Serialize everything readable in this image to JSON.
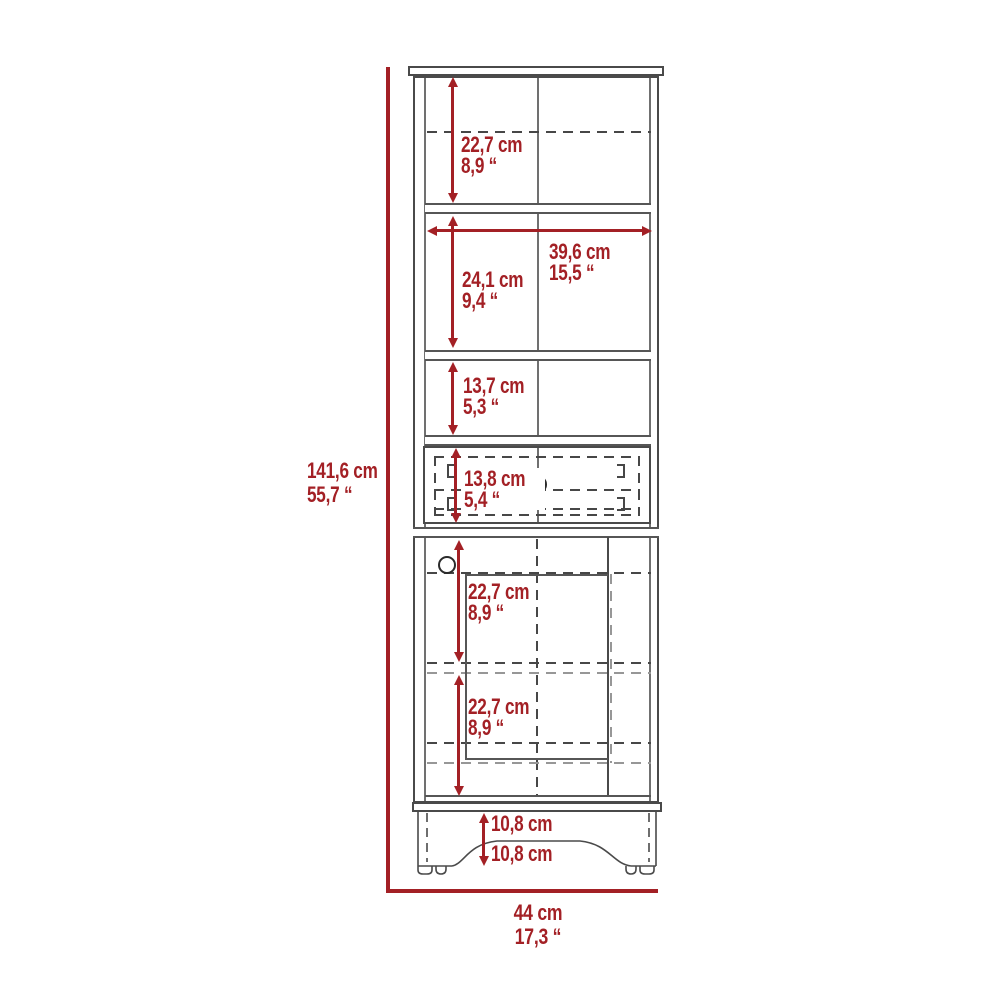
{
  "drawing": {
    "kind": "furniture dimension diagram",
    "item": "tall linen cabinet with shelves, drawer and door",
    "accent_color": "#A32025",
    "line_color": "#4a4a4a"
  },
  "dims": {
    "overall_height": {
      "cm": "141,6 cm",
      "inch": "55,7 “"
    },
    "overall_width": {
      "cm": "44 cm",
      "inch": "17,3 “"
    },
    "top_section_height": {
      "cm": "22,7 cm",
      "inch": "8,9 “"
    },
    "interior_width": {
      "cm": "39,6 cm",
      "inch": "15,5 “"
    },
    "second_section_height": {
      "cm": "24,1 cm",
      "inch": "9,4 “"
    },
    "third_section_height": {
      "cm": "13,7 cm",
      "inch": "5,3 “"
    },
    "drawer_height": {
      "cm": "13,8 cm",
      "inch": "5,4 “"
    },
    "door_upper_height": {
      "cm": "22,7 cm",
      "inch": "8,9 “"
    },
    "door_lower_height": {
      "cm": "22,7 cm",
      "inch": "8,9 “"
    },
    "base_height": {
      "cm": "10,8 cm"
    },
    "base_clearance": {
      "cm": "10,8 cm"
    }
  }
}
